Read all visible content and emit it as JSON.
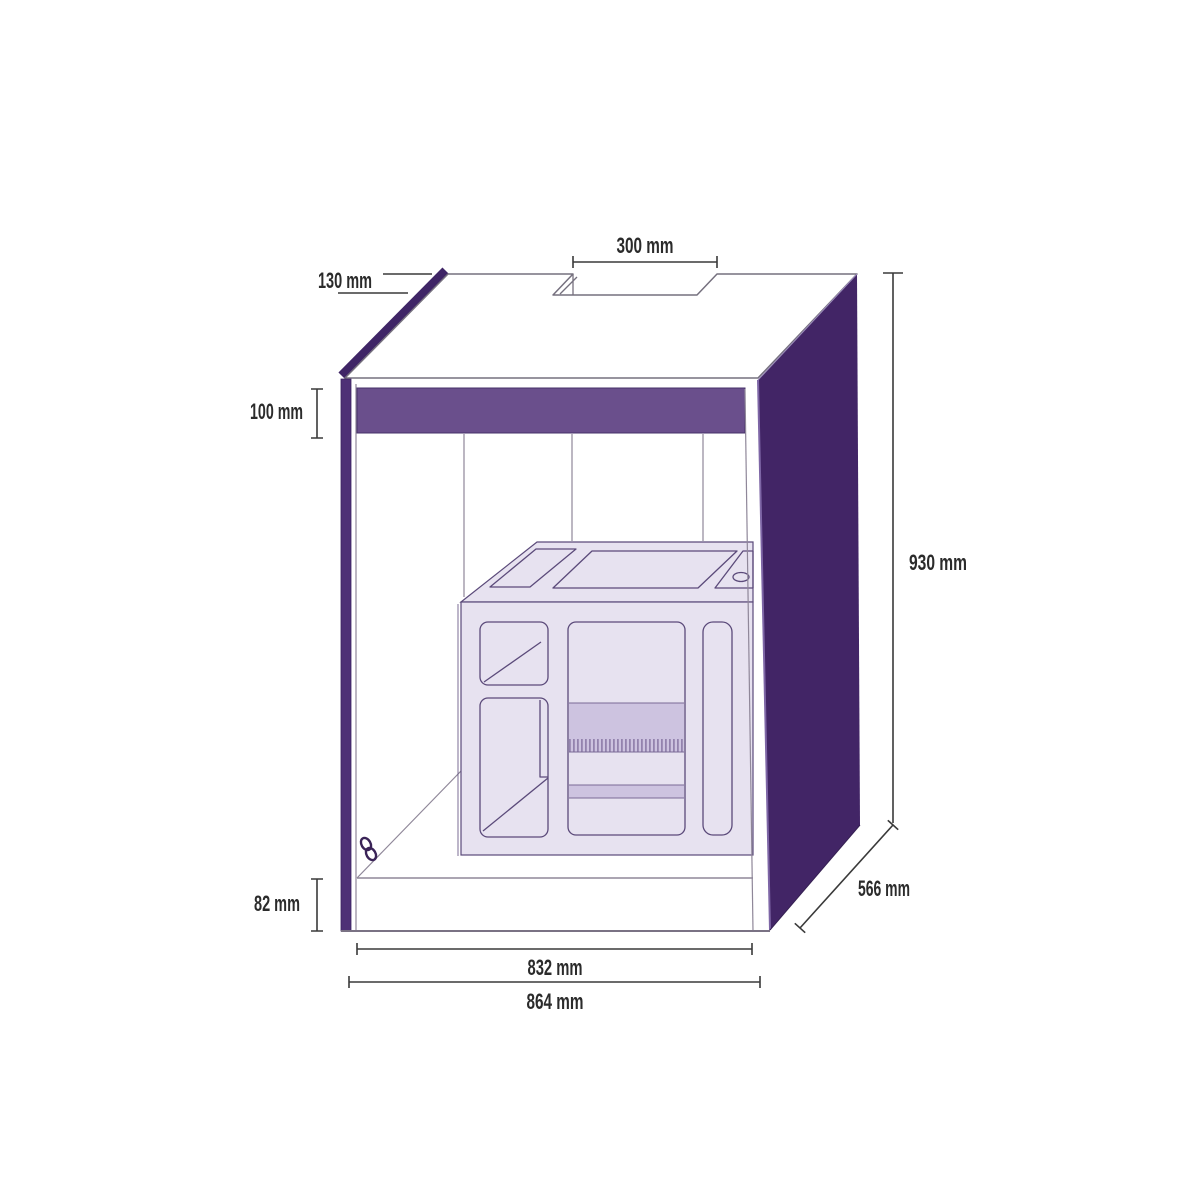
{
  "diagram": {
    "type": "furniture-dimension-diagram",
    "subject": "aquarium cabinet with internal sump",
    "unit": "mm",
    "dimensions": {
      "cutout_width": "300 mm",
      "cutout_depth": "130 mm",
      "top_rail_height": "100 mm",
      "overall_height": "930 mm",
      "overall_depth": "566 mm",
      "plinth_height": "82 mm",
      "inner_width": "832 mm",
      "outer_width": "864 mm"
    },
    "colors": {
      "background": "#ffffff",
      "side_panel": "#422566",
      "edge_band": "#3f2566",
      "left_stile": "#4e3076",
      "top_rail": "#6a4f8c",
      "panel_edge_highlight": "#7e66a6",
      "sump_fill": "#e7e2f0",
      "sump_outline": "#5b4a7a",
      "sump_band": "#cdc3e0",
      "comb_teeth": "#8d7ca8",
      "cabinet_outline": "#75707e",
      "interior_line": "#8f8799",
      "dimension_line": "#3a3a3a",
      "label_text": "#2b2b2b"
    },
    "icons": {
      "chain_link": "two interlocked rings"
    }
  }
}
